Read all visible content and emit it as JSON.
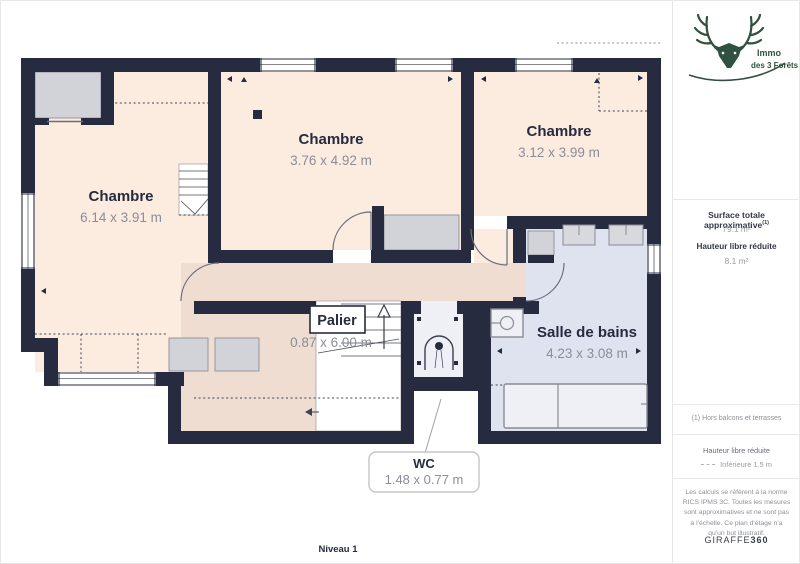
{
  "plan": {
    "level_label": "Niveau 1",
    "rooms": [
      {
        "name": "Chambre",
        "dims": "6.14 x 3.91 m"
      },
      {
        "name": "Chambre",
        "dims": "3.76 x 4.92 m"
      },
      {
        "name": "Chambre",
        "dims": "3.12 x 3.99 m"
      },
      {
        "name": "Palier",
        "dims": "0.87 x 6.00 m"
      },
      {
        "name": "Salle de bains",
        "dims": "4.23 x 3.08 m"
      },
      {
        "name": "WC",
        "dims": "1.48 x 0.77 m"
      }
    ]
  },
  "sidebar": {
    "logo": {
      "line1": "Immo",
      "line2": "des 3 Forêts"
    },
    "surface_label": "Surface totale approximative",
    "surface_sup": "(1)",
    "surface_value": "79.1 m²",
    "height_label": "Hauteur libre réduite",
    "height_value": "8.1 m²",
    "footnote": "(1) Hors balcons et terrasses",
    "legend_title": "Hauteur libre réduite",
    "legend_item": "Inférieure 1.5 m",
    "disclaimer": "Les calculs se réfèrent à la norme RICS IPMS 3C. Toutes les mesures sont approximatives et ne sont pas à l'échelle. Ce plan d'étage n'a qu'un but illustratif.",
    "brand": "GIRAFFE",
    "brand_bold": "360"
  },
  "colors": {
    "wall": "#262b40",
    "bedroom_fill": "#fcebdf",
    "landing_fill": "#eeddd0",
    "bathroom_fill": "#dfe3ef",
    "closet_fill": "#d2d3d8",
    "logo_green": "#30513f"
  }
}
